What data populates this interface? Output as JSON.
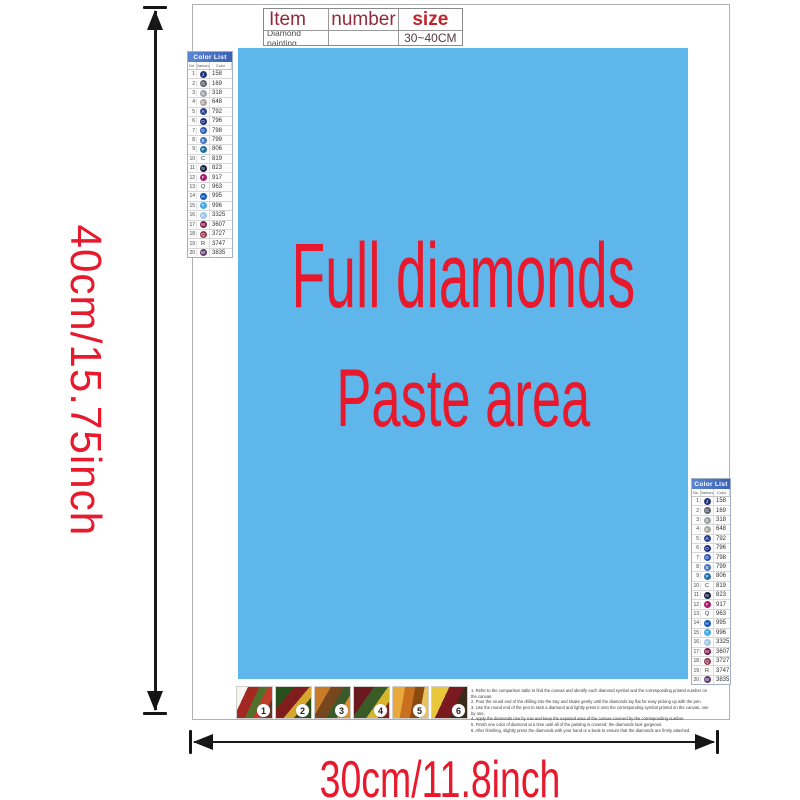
{
  "dimensions": {
    "height_label": "40cm/15.75inch",
    "width_label": "30cm/11.8inch"
  },
  "item_table": {
    "headers": [
      "Item",
      "number",
      "size"
    ],
    "row": {
      "item": "Diamond painting",
      "number": "",
      "size": "30~40CM"
    }
  },
  "paste_area": {
    "line1": "Full diamonds",
    "line2": "Paste area",
    "bg_color": "#5fb6ea",
    "text_color": "#e8192d"
  },
  "color_list": {
    "title": "Color List",
    "columns": [
      "No.",
      "Diamond",
      "Color"
    ],
    "rows": [
      {
        "no": "1",
        "symbol": "J",
        "bg": "#25357e",
        "code": "158"
      },
      {
        "no": "2",
        "symbol": "G",
        "bg": "#5c6470",
        "code": "169"
      },
      {
        "no": "3",
        "symbol": "S",
        "bg": "#9ca0a8",
        "code": "318"
      },
      {
        "no": "4",
        "symbol": "E",
        "bg": "#a9a79d",
        "code": "648"
      },
      {
        "no": "5",
        "symbol": "A",
        "bg": "#2c4193",
        "code": "792"
      },
      {
        "no": "6",
        "symbol": "O",
        "bg": "#1c2f7e",
        "code": "796"
      },
      {
        "no": "7",
        "symbol": "D",
        "bg": "#2a58b0",
        "code": "798"
      },
      {
        "no": "8",
        "symbol": "B",
        "bg": "#4672c4",
        "code": "799"
      },
      {
        "no": "9",
        "symbol": "P",
        "bg": "#1e6fa8",
        "code": "806"
      },
      {
        "no": "10",
        "symbol": "C",
        "bg": "",
        "code": "819"
      },
      {
        "no": "11",
        "symbol": "N",
        "bg": "#141f45",
        "code": "823"
      },
      {
        "no": "12",
        "symbol": "F",
        "bg": "#a8186e",
        "code": "917"
      },
      {
        "no": "13",
        "symbol": "Q",
        "bg": "",
        "code": "963"
      },
      {
        "no": "14",
        "symbol": "H",
        "bg": "#0e57b8",
        "code": "995"
      },
      {
        "no": "15",
        "symbol": "T",
        "bg": "#3fa9e8",
        "code": "996"
      },
      {
        "no": "16",
        "symbol": "K",
        "bg": "#9fc4e8",
        "code": "3325"
      },
      {
        "no": "17",
        "symbol": "M",
        "bg": "#7e1c4e",
        "code": "3607"
      },
      {
        "no": "18",
        "symbol": "Q",
        "bg": "#96374e",
        "code": "3727"
      },
      {
        "no": "19",
        "symbol": "R",
        "bg": "",
        "code": "3747"
      },
      {
        "no": "20",
        "symbol": "W",
        "bg": "#5c3a6e",
        "code": "3835"
      }
    ]
  },
  "steps": {
    "labels": [
      "1",
      "2",
      "3",
      "4",
      "5",
      "6"
    ]
  },
  "instructions": {
    "lines": [
      "1. Refer to the comparison table to find the canvas and identify each diamond symbol and the corresponding printed number on the canvas.",
      "2. Pour the round end of the drilling into the tray and shake gently until the diamonds lay flat for easy picking up with the pen.",
      "3. Use the round end of the pen to stick a diamond and lightly press it onto the corresponding symbol printed on the canvas, one by one.",
      "4. Apply the diamonds row by row and keep the exposed area of the canvas covered by the corresponding number.",
      "5. Finish one color of diamond at a time until all of the painting is covered; the diamonds look gorgeous.",
      "6. After finishing, slightly press the diamonds with your hand or a book to ensure that the diamonds are firmly attached."
    ]
  }
}
